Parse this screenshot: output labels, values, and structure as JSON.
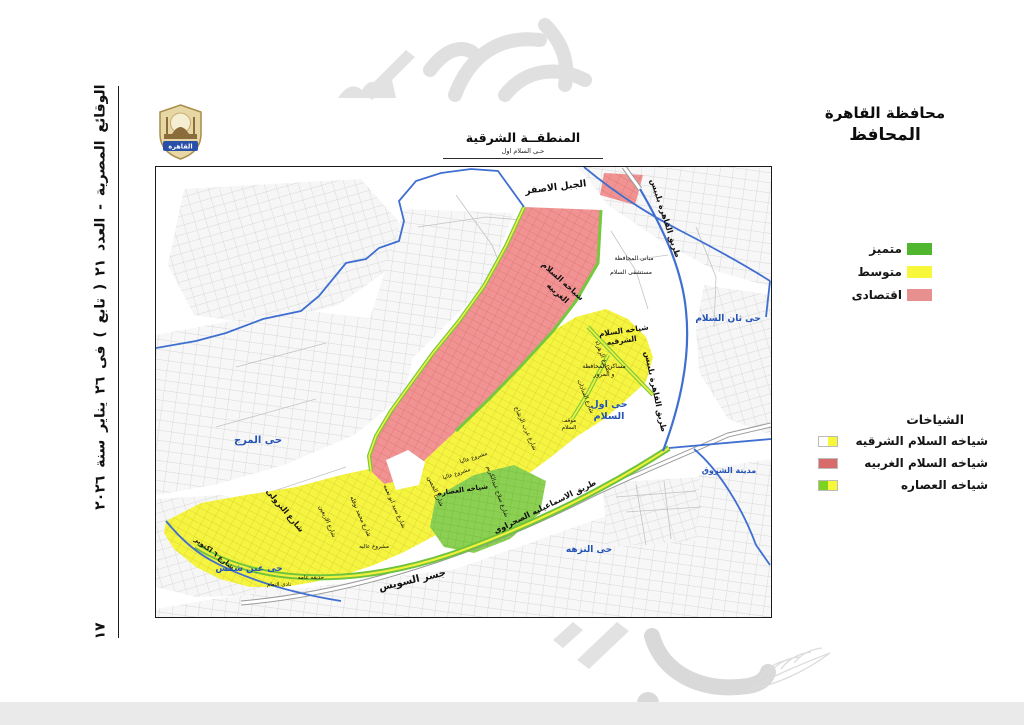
{
  "sidebar": {
    "issue_line": "الوقائع المصرية - العدد ٢١ ( تابع ) فى ٢٦ يناير سنة ٢٠٢٦",
    "page_number": "١٧"
  },
  "header": {
    "governorate": "محافظة القاهرة",
    "governor": "المحافظ"
  },
  "map_title": {
    "title": "المنطقــة الشرقية",
    "subtitle": "حـى السلام اول"
  },
  "logo": {
    "label": "القاهرة"
  },
  "legend_levels": {
    "items": [
      {
        "label": "متميز",
        "color": "#4fb62e"
      },
      {
        "label": "متوسط",
        "color": "#f8f83a"
      },
      {
        "label": "اقتصادى",
        "color": "#e89090"
      }
    ]
  },
  "legend_districts": {
    "title": "الشياخات",
    "items": [
      {
        "label": "شياخه السلام الشرقيه",
        "color_left": "#ffffff",
        "color_right": "#f8f83a"
      },
      {
        "label": "شياخه السلام الغربيه",
        "color_left": "#d96a6a",
        "color_right": "#d96a6a"
      },
      {
        "label": "شياخه العصاره",
        "color_left": "#7ed321",
        "color_right": "#f8f83a"
      }
    ]
  },
  "labels": {
    "jabal_asfar": "الجبل الاصفر",
    "cairo_belbeis_road": "طريق القاهرة بلبيس",
    "salam_gharbia_l1": "شياخه السلام",
    "salam_gharbia_l2": "الغربيه",
    "salam_sharkia_l1": "شياخه السلام",
    "salam_sharkia_l2": "الشرقيه",
    "govern_buildings": "مبانى المحافظة",
    "salam_hospital": "مستشفى السلام",
    "zahraa_st": "شارع الزهراء",
    "masaken_l1": "مساكن المحافظة",
    "masaken_l2": "و المرور",
    "sadat_st": "شارع السادات",
    "mawkaf_l1": "موقف",
    "mawkaf_l2": "السلام",
    "osara": "شياخه العصاره",
    "gesr_suez": "جسر السويس",
    "ismailia_road": "طريق الاسماعيليه الصحراوى",
    "trolley_st": "شارع الترولى",
    "october_st": "شارع ٦ اكتوبر",
    "arbain_st": "شارع الاربعين",
    "nofala_st": "شارع محمد نوفله",
    "abou_nemaa_st": "شارع سيد ابو نعمه",
    "hosn_st": "شارع الحصن",
    "abdelkarim_st": "شارع صلاح عبدالكريم",
    "arab_rashah_st": "شارع عرب الرشاح",
    "mashrou_alia": "مشروع عاليا",
    "mashrou_alia2": "مشروع عاليه",
    "hadika": "حديقه عامه",
    "nadi_naam": "نادى النعام",
    "marg": "حى المرج",
    "ain_shams": "حى عين شمس",
    "awal_salam_l1": "حى اول",
    "awal_salam_l2": "السلام",
    "than_salam": "حى ثان السلام",
    "nozha": "حى النزهه",
    "shorouk": "مدينة الشروق"
  },
  "colors": {
    "zone_red": "#f09392",
    "zone_yellow": "#f5f440",
    "zone_green": "#8bd052",
    "boundary_blue": "#3f6fd0",
    "district_label_blue": "#2353b5"
  }
}
